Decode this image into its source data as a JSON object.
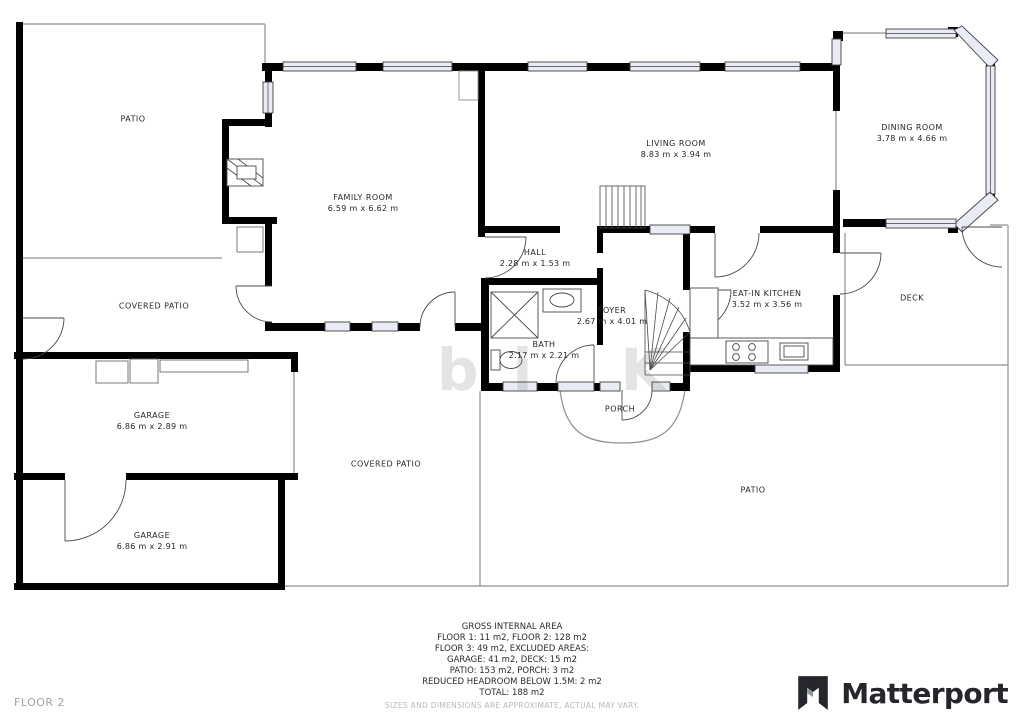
{
  "floor_label": "FLOOR 2",
  "watermark": "bi K",
  "brand": {
    "name": "Matterport"
  },
  "area_summary": {
    "title": "GROSS INTERNAL AREA",
    "lines": [
      "FLOOR 1: 11 m2, FLOOR 2: 128 m2",
      "FLOOR 3: 49 m2, EXCLUDED AREAS:",
      "GARAGE: 41 m2, DECK: 15 m2",
      "PATIO: 153 m2, PORCH: 3 m2",
      "REDUCED HEADROOM BELOW 1.5M: 2 m2",
      "TOTAL: 188 m2"
    ],
    "disclaimer": "SIZES AND DIMENSIONS ARE APPROXIMATE, ACTUAL MAY VARY."
  },
  "rooms": [
    {
      "name": "PATIO",
      "dims": ""
    },
    {
      "name": "FAMILY ROOM",
      "dims": "6.59 m x 6.62 m"
    },
    {
      "name": "LIVING ROOM",
      "dims": "8.83 m x 3.94 m"
    },
    {
      "name": "DINING ROOM",
      "dims": "3.78 m x 4.66 m"
    },
    {
      "name": "HALL",
      "dims": "2.28 m x 1.53 m"
    },
    {
      "name": "FOYER",
      "dims": "2.67 m x 4.01 m"
    },
    {
      "name": "BATH",
      "dims": "2.17 m x 2.21 m"
    },
    {
      "name": "EAT-IN KITCHEN",
      "dims": "3.52 m x 3.56 m"
    },
    {
      "name": "DECK",
      "dims": ""
    },
    {
      "name": "COVERED PATIO",
      "dims": ""
    },
    {
      "name": "GARAGE",
      "dims": "6.86 m x 2.89 m"
    },
    {
      "name": "COVERED PATIO",
      "dims": ""
    },
    {
      "name": "PORCH",
      "dims": ""
    },
    {
      "name": "PATIO",
      "dims": ""
    },
    {
      "name": "GARAGE",
      "dims": "6.86 m x 2.91 m"
    }
  ],
  "colors": {
    "wall": "#000000",
    "thin_line": "#8f8f8f",
    "window_fill": "#e9ecf5",
    "brand_text": "#24262b"
  }
}
